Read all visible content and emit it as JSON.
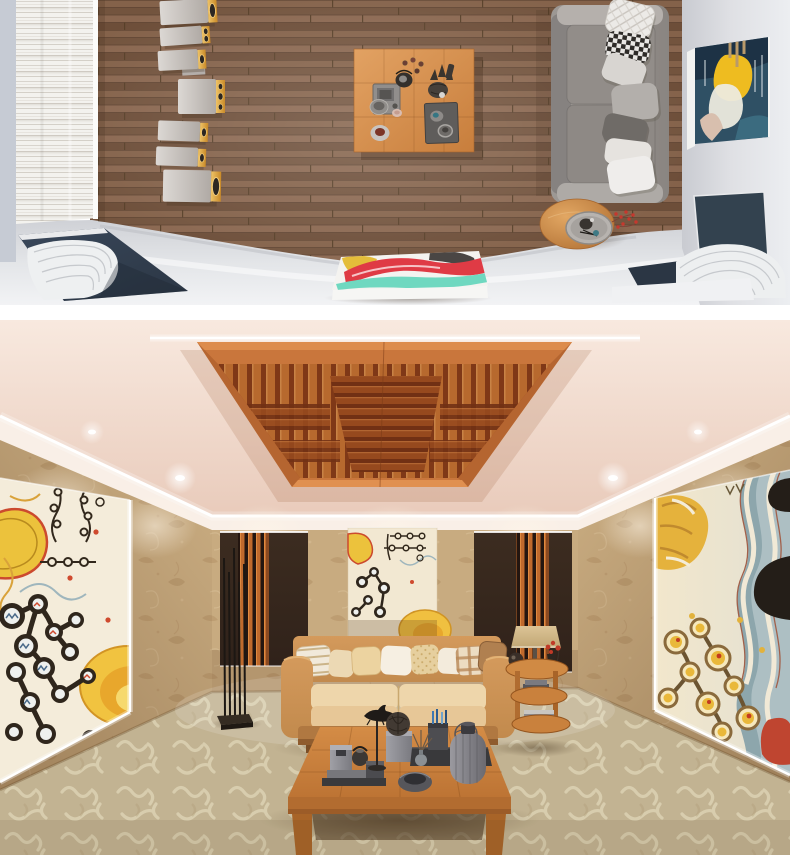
{
  "palette": {
    "page_bg": "#ffffff",
    "wood_floor": "#7d5c43",
    "left_wall": "#c6cbd4",
    "fluted_panel": "#f3f2ee",
    "floor_band": "#cfd1d6",
    "floor_band_light": "#f2f3f5",
    "navy_panel": "#2b3644",
    "speaker_gold": "#c98a28",
    "speaker_gold_light": "#eec367",
    "table_wood": "#c87e3c",
    "sofa_frame": "#9d9894",
    "sofa_cushion": "#928d89",
    "sofa_arm": "#b5b0ac",
    "pillow_white": "#efedeb",
    "pillow_light": "#d8d5d1",
    "pillow_mid": "#b3afab",
    "pillow_dark": "#6f6b67",
    "checker_dark": "#2e2b28",
    "right_wall": "#dfe0e4",
    "painting_teal": "#2f5064",
    "painting_navy": "#1d3245",
    "painting_yellow": "#eebc20",
    "berry_red": "#c6382e",
    "canvas_white": "#f4f3f0",
    "canvas_red": "#df3b45",
    "canvas_teal": "#6fd8c0",
    "canvas_yellow": "#e4bd3a",
    "ceiling": "#f8e9df",
    "led": "#ffffff",
    "panel_border": "#c9763c",
    "panel_core": "#8c3f1c",
    "panel_slat": "#d07a38",
    "panel_slat_dark": "#a85424",
    "wallpaper": "#c8ab80",
    "dark_panel": "#30221a",
    "slat_orange": "#bf6a2d",
    "art_cream": "#f4ecda",
    "art_yellow": "#ecc23c",
    "sofa_tan": "#c28a4d",
    "sofa_cream": "#eed6ab",
    "carpet": "#cbbd9c",
    "carpet_motif": "#e8dfc0",
    "coffee_wood": "#d48c46",
    "charcoal": "#3b393b",
    "lamp_shade": "#dcc496"
  },
  "scene_top": {
    "label": "Top-down 3D render of a hi-fi listening room",
    "objects": [
      "fluted white acoustic wall panel",
      "vertical array of seven wood-trimmed loudspeakers",
      "walnut plank floor",
      "square oak coffee table with decor objects",
      "grey three-seat sofa with scatter cushions",
      "round oak side table with tray and red berry sprig",
      "abstract painting leaning on the right wall",
      "navy corner bass traps with curved white diffusers",
      "abstract painted canvas on the front ledge"
    ]
  },
  "scene_bottom": {
    "label": "Eye-level 3D render of the same listening lounge",
    "objects": [
      "suspended orange wooden ceiling diffuser with LED cove lighting",
      "recessed ceiling downlights",
      "beige damask wallpaper",
      "large abstract mural on the left wall",
      "large abstract mural on the right wall",
      "hanging abstract tapestry on the back wall",
      "two dark acoustic panels with orange slats",
      "black multi-rod floor lamp",
      "tan leather sofa with eight patterned pillows",
      "three-tier round wooden side table with lamp, vases and books",
      "low square wooden coffee table with charcoal decor objects",
      "patterned beige carpet"
    ]
  }
}
